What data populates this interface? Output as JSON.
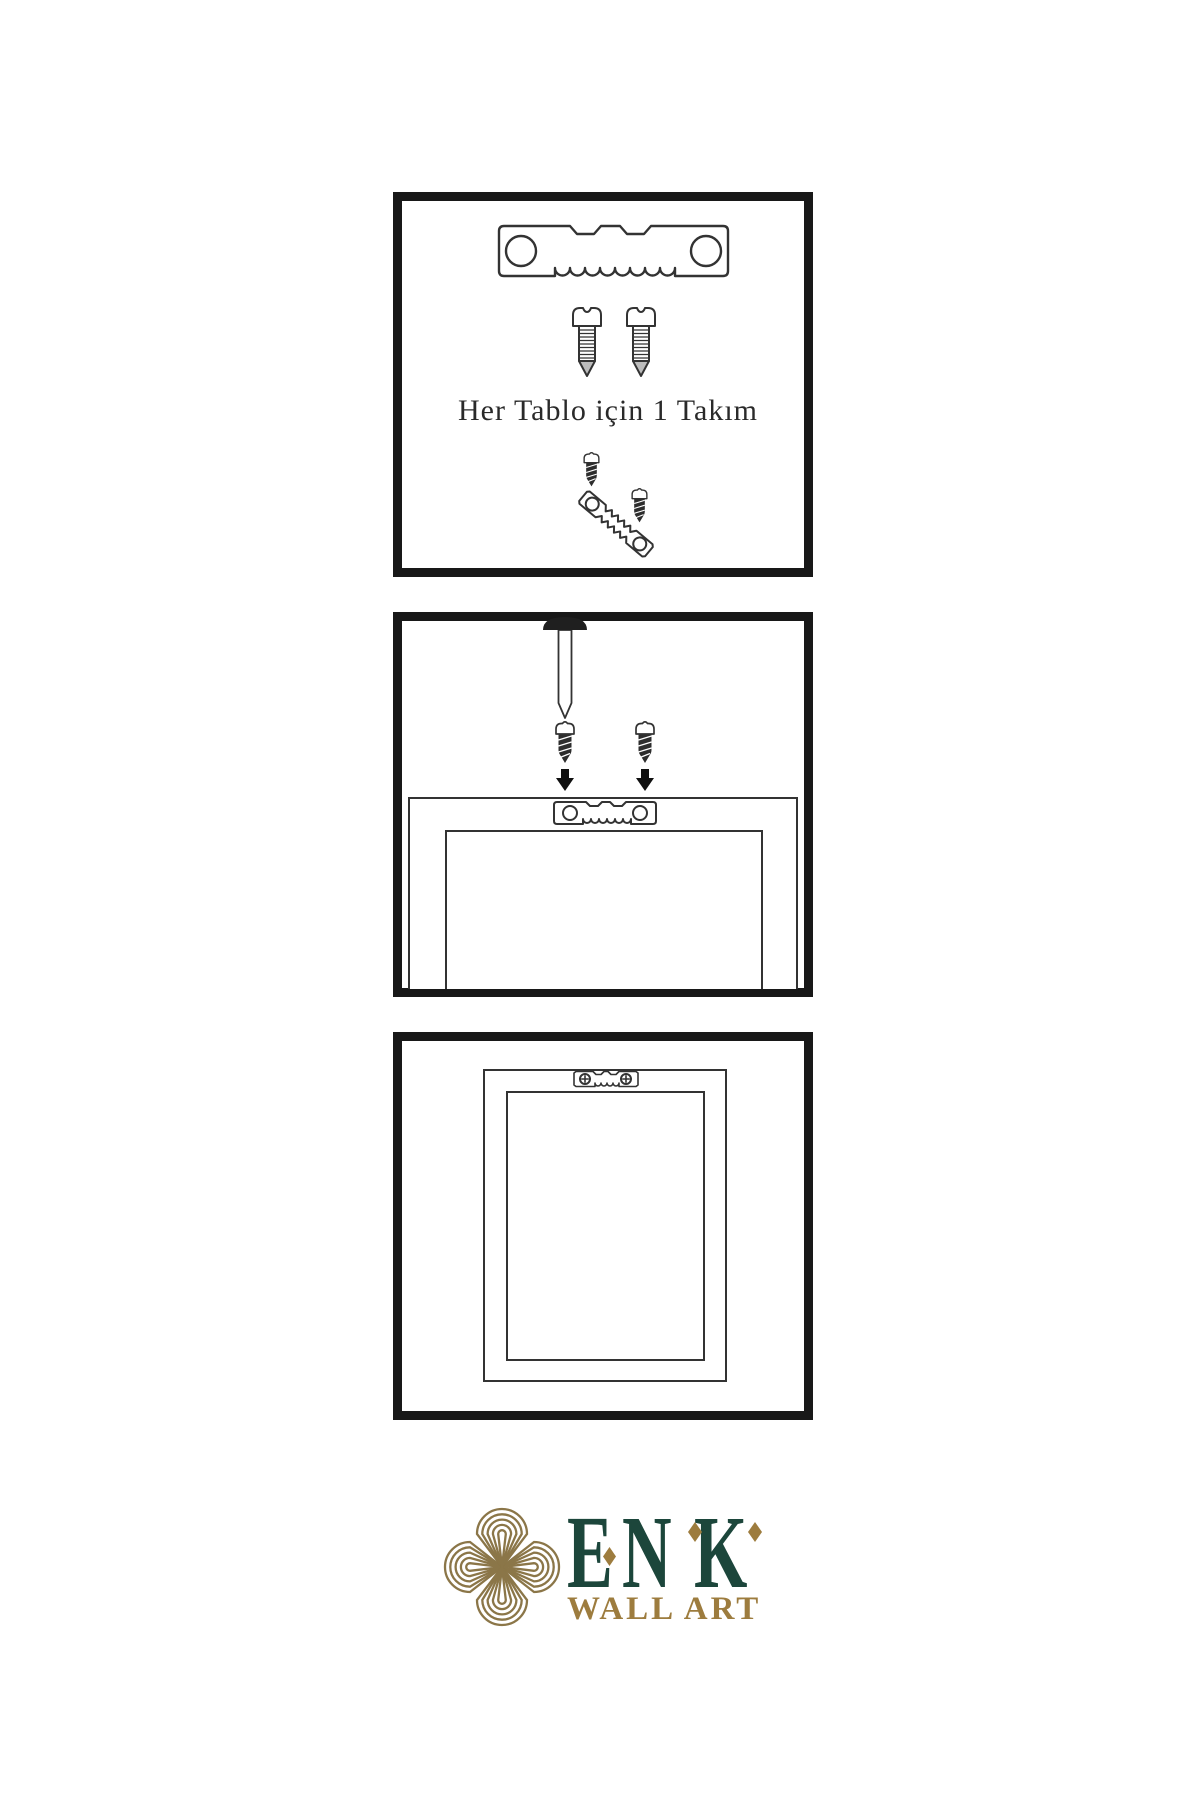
{
  "step1": {
    "caption": "Her Tablo için 1 Takım"
  },
  "brand": {
    "name": "ENK",
    "letters": [
      "E",
      "N",
      "K"
    ],
    "tagline": "WALL ART"
  },
  "colors": {
    "panel_border": "#181818",
    "outline": "#333333",
    "ink": "#2a2a2a",
    "screw_dark": "#2d2d2d",
    "brand_green": "#1c463b",
    "brand_gold": "#9d7c3e",
    "knot_gold": "#8b7648"
  }
}
